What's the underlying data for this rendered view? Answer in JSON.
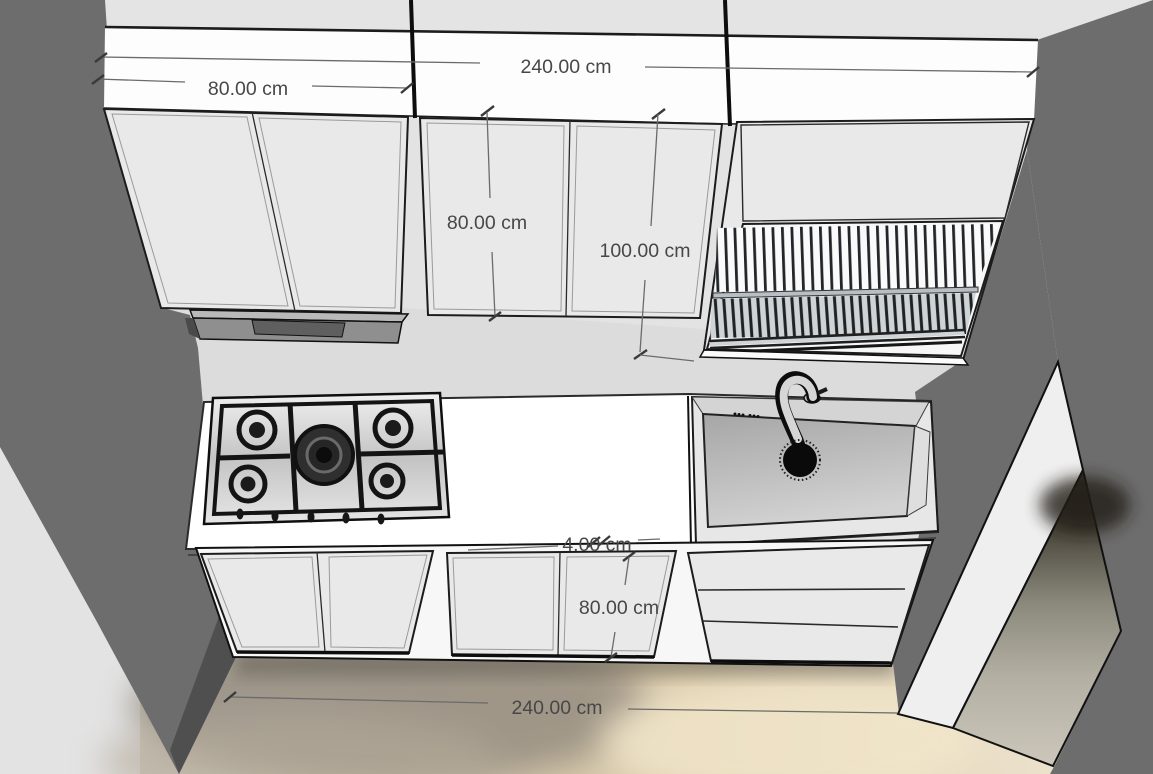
{
  "scene": {
    "description": "3D kitchen model with dimension annotations",
    "unit": "cm",
    "objects": [
      "upper-cabinet-left",
      "upper-cabinet-middle",
      "upper-cabinet-dish-rack",
      "range-hood",
      "gas-cooktop-5-burner",
      "countertop",
      "kitchen-sink",
      "gooseneck-faucet",
      "base-cabinet-left",
      "base-cabinet-middle",
      "base-cabinet-drawers"
    ]
  },
  "annotations": {
    "upper_left_cabinet_width": "80.00 cm",
    "upper_run_total_width": "240.00 cm",
    "upper_middle_cabinet_height": "80.00 cm",
    "upper_right_cabinet_height": "100.00 cm",
    "countertop_thickness": "4.00 cm",
    "base_cabinet_height": "80.00 cm",
    "base_run_total_width": "240.00 cm"
  },
  "colors": {
    "wall_dark": "#6d6d6d",
    "wall_light": "#dcdcdc",
    "cabinet_face": "#e9e9e9",
    "cabinet_top": "#fdfdfd",
    "counter": "#ffffff",
    "floor_tan": "#d9c9a8",
    "dimension_text": "#474747"
  }
}
